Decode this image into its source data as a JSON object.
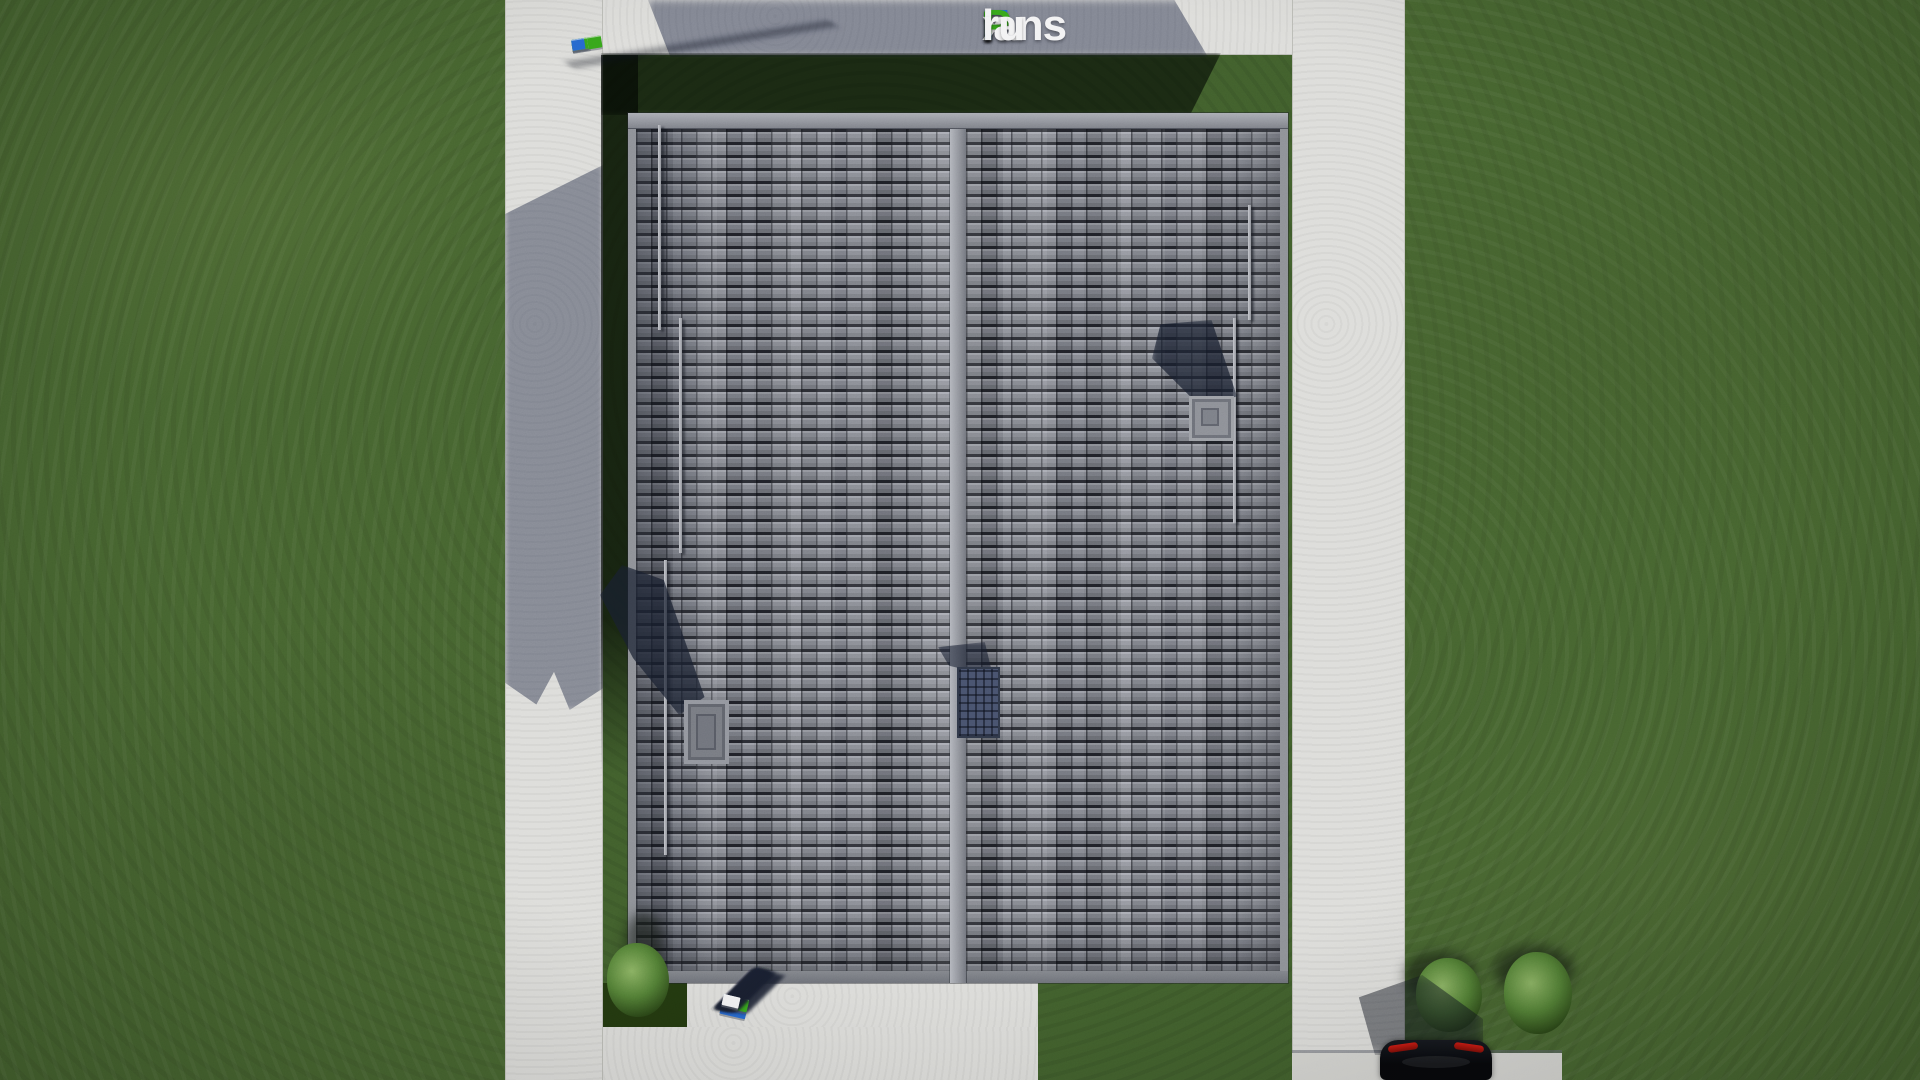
{
  "watermark": {
    "full_text": "FixPlans.ru",
    "f": "F",
    "i_stem": "ı",
    "x": "x",
    "p": "P",
    "lans": "lans",
    "dot": ".",
    "ru": "ru"
  },
  "palette": {
    "lawn": "#44612e",
    "lawn_shadow": "#18220f",
    "concrete": "#dcdcd9",
    "concrete_shadow": "#8e94a5",
    "roof_tile": "#7e818a",
    "roof_gap": "#23252c",
    "roof_cap": "#9a9da5",
    "logo_blue": "#2565cd",
    "logo_green": "#35a31a",
    "logo_white": "#f2f2f3",
    "taillight": "#c81a12",
    "car_body": "#0b0d11",
    "bush_green": "#5f8a3c"
  },
  "strips": {
    "top": {
      "shadows": false,
      "blocks": [
        {
          "c": "w",
          "w": 17,
          "h": 10
        },
        {
          "c": "w",
          "w": 15,
          "h": 10
        },
        {
          "c": "w",
          "w": 11,
          "h": 9
        },
        {
          "c": "b",
          "w": 18,
          "h": 12
        },
        {
          "c": "w",
          "w": 14,
          "h": 10
        },
        {
          "c": "w",
          "w": 16,
          "h": 11
        },
        {
          "c": "w",
          "w": 16,
          "h": 11
        },
        {
          "c": "w",
          "w": 9,
          "h": 9
        },
        {
          "c": "g",
          "w": 30,
          "h": 12
        },
        {
          "c": "w",
          "w": 16,
          "h": 11
        },
        {
          "c": "w",
          "w": 14,
          "h": 11
        },
        {
          "c": "g",
          "w": 16,
          "h": 11
        },
        {
          "c": "b",
          "w": 13,
          "h": 11
        }
      ]
    },
    "bottom": {
      "shadows": true,
      "blocks": [
        {
          "c": "b",
          "w": 26,
          "h": 20
        },
        {
          "c": "g",
          "w": 10,
          "h": 9
        },
        {
          "c": "w",
          "w": 13,
          "h": 11
        },
        {
          "c": "w",
          "w": 15,
          "h": 12
        },
        {
          "c": "g",
          "w": 26,
          "h": 13
        },
        {
          "c": "w",
          "w": 9,
          "h": 10
        },
        {
          "c": "w",
          "w": 17,
          "h": 12
        },
        {
          "c": "w",
          "w": 13,
          "h": 11
        },
        {
          "c": "w",
          "w": 15,
          "h": 12
        },
        {
          "c": "w",
          "w": 17,
          "h": 12
        },
        {
          "c": "b",
          "w": 11,
          "h": 10
        },
        {
          "c": "w",
          "w": 13,
          "h": 11
        },
        {
          "c": "w",
          "w": 17,
          "h": 11
        }
      ]
    }
  }
}
